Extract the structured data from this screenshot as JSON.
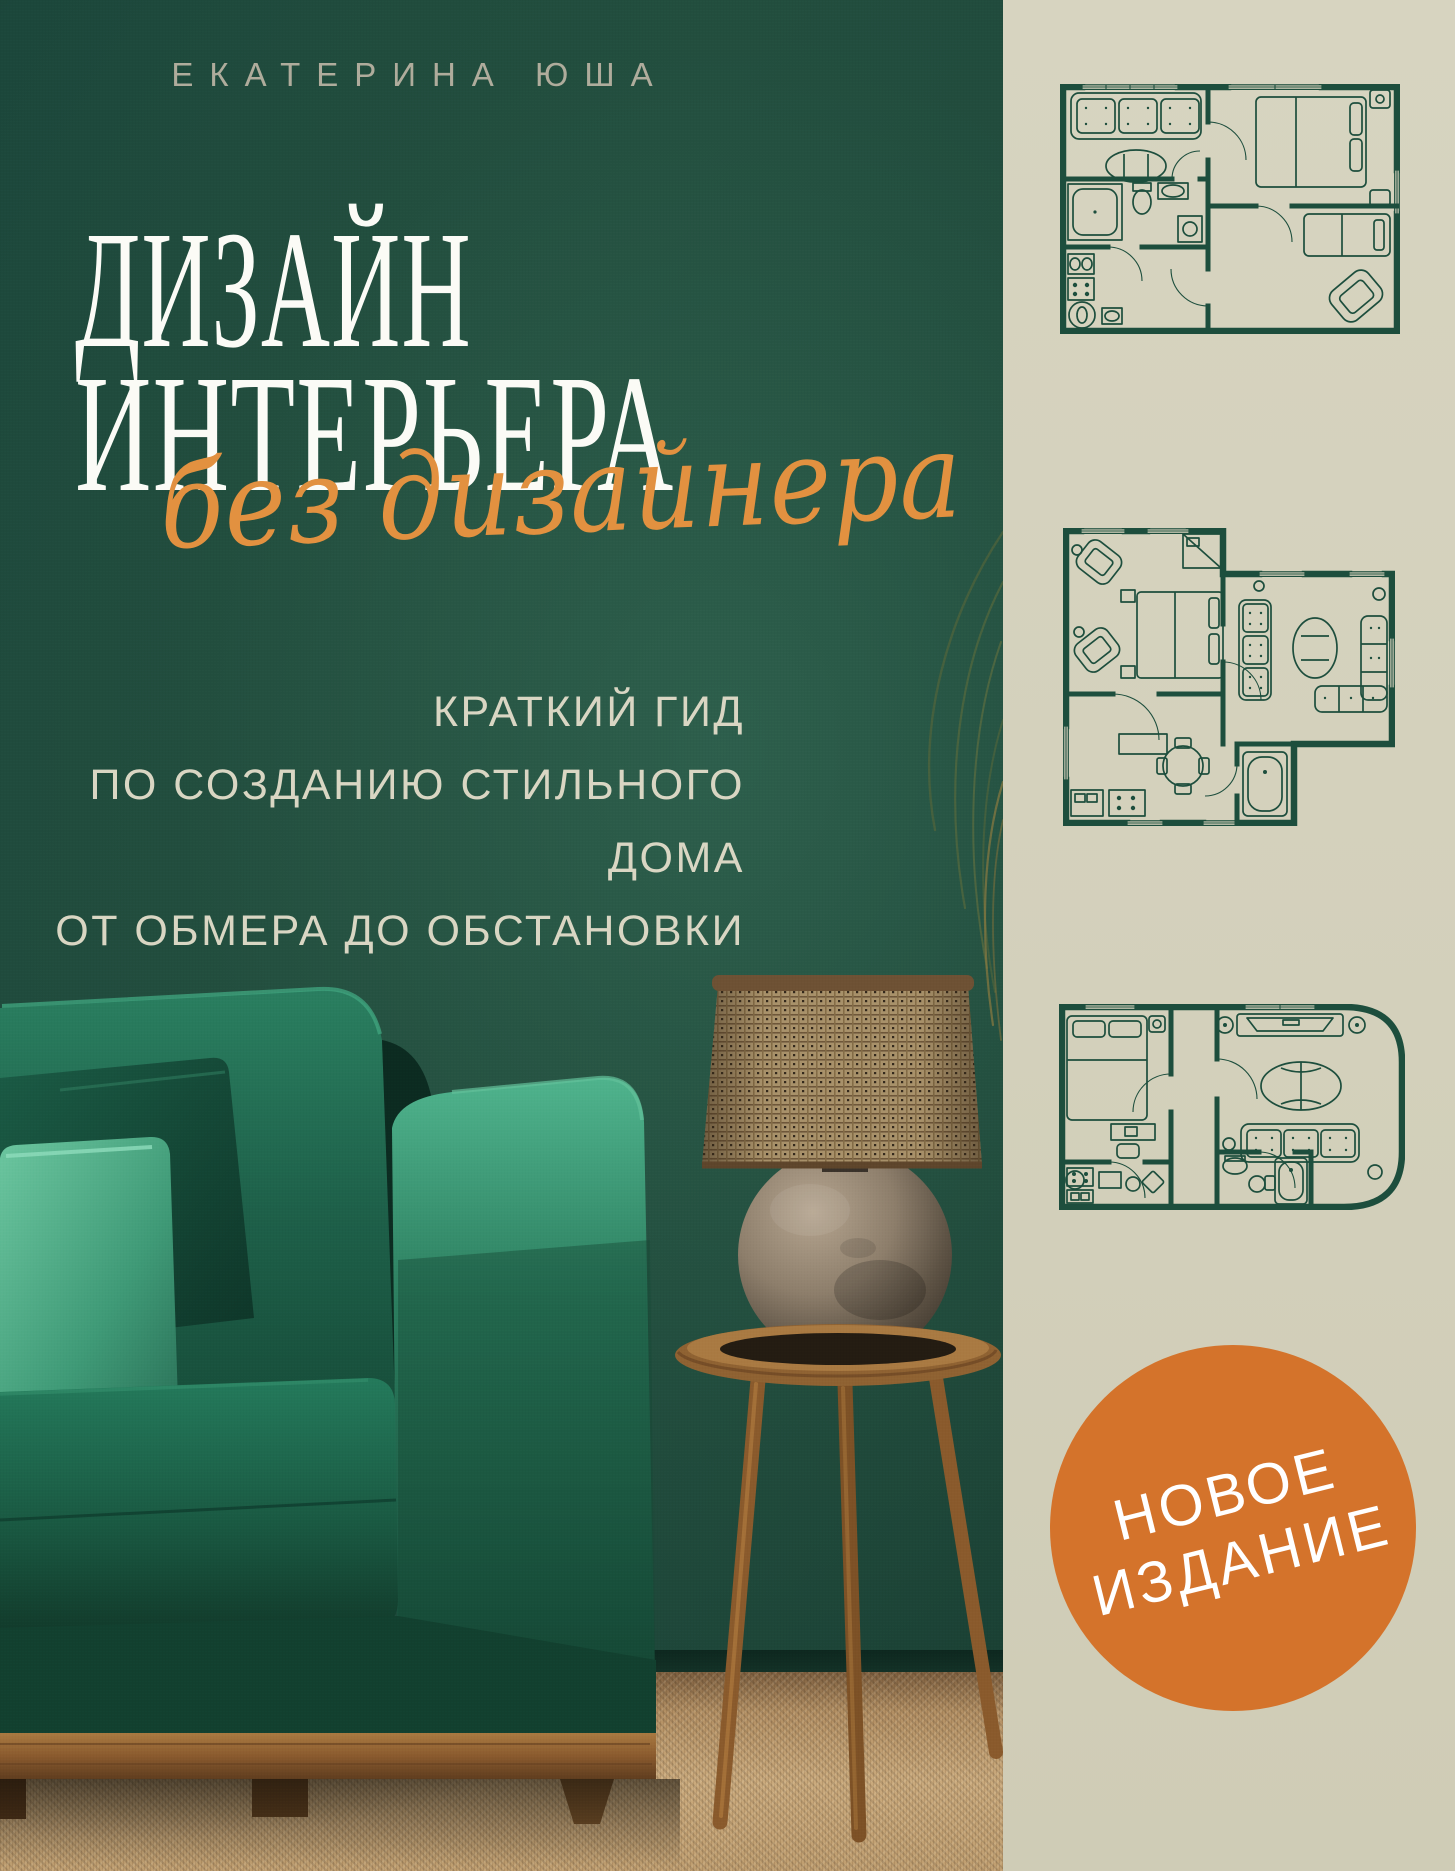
{
  "cover": {
    "author": "ЕКАТЕРИНА ЮША",
    "title_line1": "ДИЗАЙН",
    "title_line2": "ИНТЕРЬЕРА",
    "title_script": "без дизайнера",
    "subtitle_lines": [
      "КРАТКИЙ ГИД",
      "ПО СОЗДАНИЮ СТИЛЬНОГО ДОМА",
      "ОТ ОБМЕРА ДО ОБСТАНОВКИ"
    ],
    "badge": {
      "line1": "НОВОЕ",
      "line2": "ИЗДАНИЕ"
    }
  },
  "colors": {
    "wall_green": "#1F4A3C",
    "accent_orange": "#D4732B",
    "script_orange": "#E29140",
    "panel_beige": "#D4D1BC",
    "plan_line": "#1D4E3D",
    "title_white": "#FBFBF6",
    "subtitle_beige": "#D9D6C3",
    "author_gray": "#AFAC9C",
    "sofa_emerald": "#1E6B50",
    "mint": "#5FC09A",
    "wood": "#96672F",
    "carpet": "#C5A478"
  },
  "icons": {
    "floor_plan_top": "apartment-floor-plan-icon",
    "floor_plan_middle": "apartment-floor-plan-icon",
    "floor_plan_bottom": "apartment-floor-plan-icon",
    "scene": "green-sofa-lamp-side-table-photo"
  }
}
